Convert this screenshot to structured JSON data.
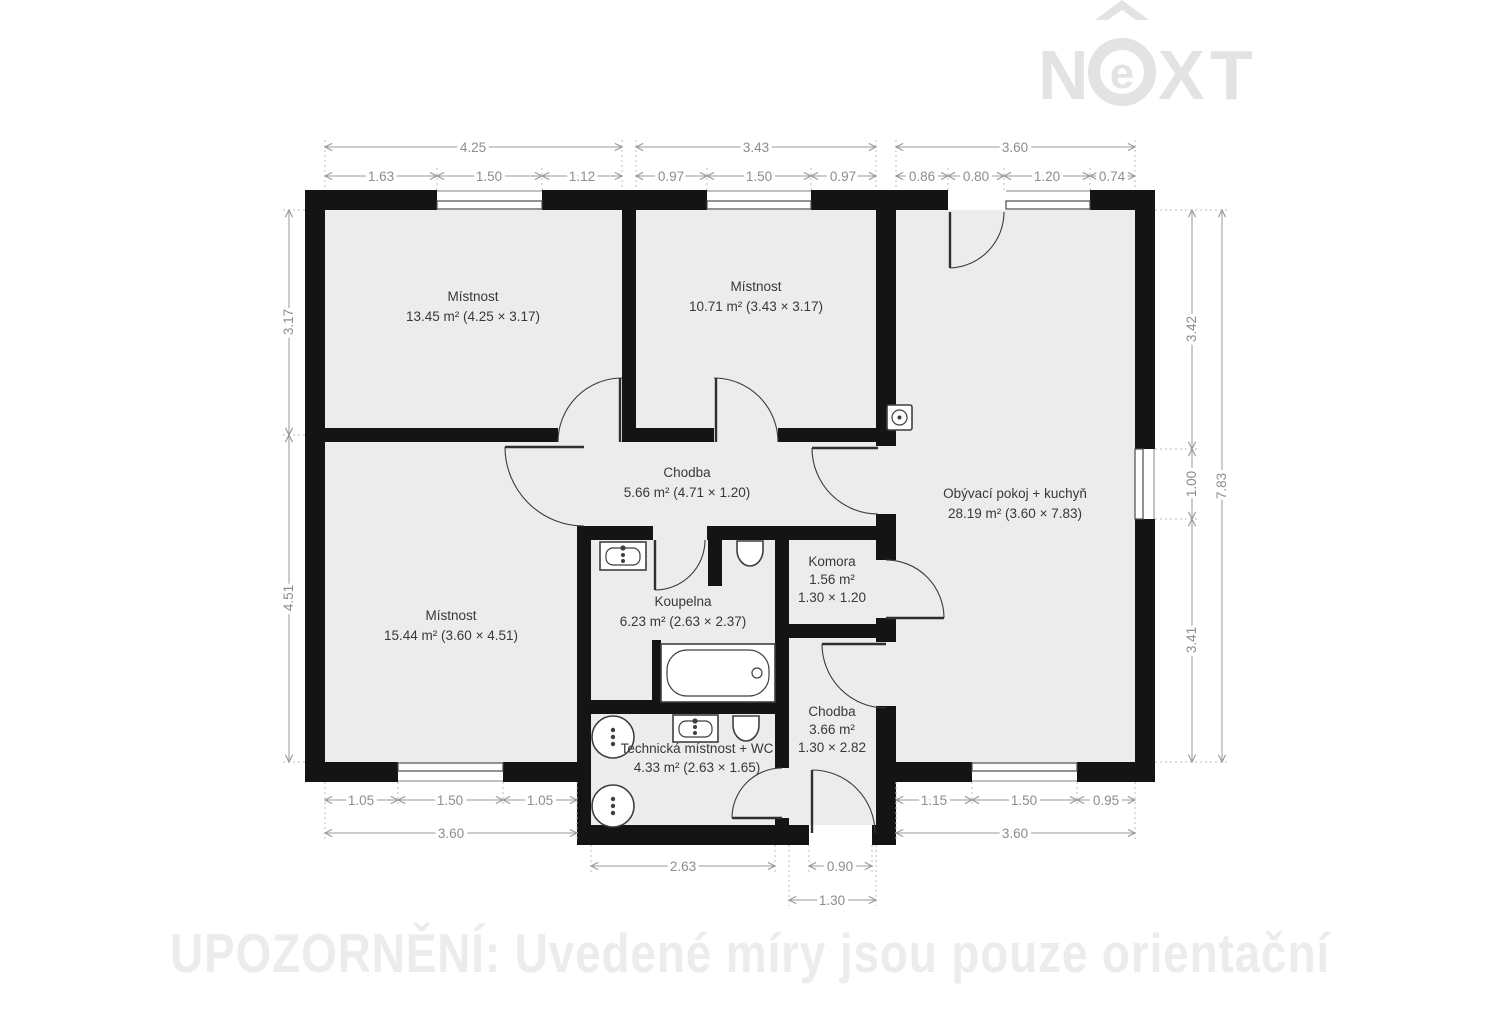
{
  "brand": {
    "logo_n": "N",
    "logo_e": "e",
    "logo_x": "X",
    "logo_t": "T"
  },
  "watermark": {
    "notice": "UPOZORNĚNÍ: Uvedené míry jsou pouze orientační"
  },
  "rooms": {
    "mistnost1": {
      "name": "Místnost",
      "detail": "13.45 m² (4.25 × 3.17)"
    },
    "mistnost2": {
      "name": "Místnost",
      "detail": "10.71 m² (3.43 × 3.17)"
    },
    "living": {
      "name": "Obývací pokoj + kuchyň",
      "detail": "28.19 m² (3.60 × 7.83)"
    },
    "chodba1": {
      "name": "Chodba",
      "detail": "5.66 m² (4.71 × 1.20)"
    },
    "mistnost3": {
      "name": "Místnost",
      "detail": "15.44 m² (3.60 × 4.51)"
    },
    "koupelna": {
      "name": "Koupelna",
      "detail": "6.23 m² (2.63 × 2.37)"
    },
    "komora": {
      "name": "Komora",
      "area": "1.56 m²",
      "size": "1.30 × 1.20"
    },
    "chodba2": {
      "name": "Chodba",
      "area": "3.66 m²",
      "size": "1.30 × 2.82"
    },
    "technicka": {
      "name": "Technická místnost + WC",
      "detail": "4.33 m² (2.63 × 1.65)"
    }
  },
  "dims": {
    "top_main": [
      "4.25",
      "3.43",
      "3.60"
    ],
    "top_sub": [
      "1.63",
      "1.50",
      "1.12",
      "0.97",
      "1.50",
      "0.97",
      "0.86",
      "0.80",
      "1.20",
      "0.74"
    ],
    "left": [
      "3.17",
      "4.51"
    ],
    "right_inner": [
      "3.42",
      "1.00",
      "3.41"
    ],
    "right_total": "7.83",
    "bottom_sub": [
      "1.05",
      "1.50",
      "1.05",
      "1.15",
      "1.50",
      "0.95"
    ],
    "bottom_main_left": "3.60",
    "bottom_main_right": "3.60",
    "bottom_tech": "2.63",
    "bottom_entry_door": "0.90",
    "bottom_entry_total": "1.30"
  },
  "colors": {
    "wall": "#141414",
    "floor": "#ececec",
    "dimension_text": "#8d8d8d",
    "watermark": "#e3e3e3"
  }
}
